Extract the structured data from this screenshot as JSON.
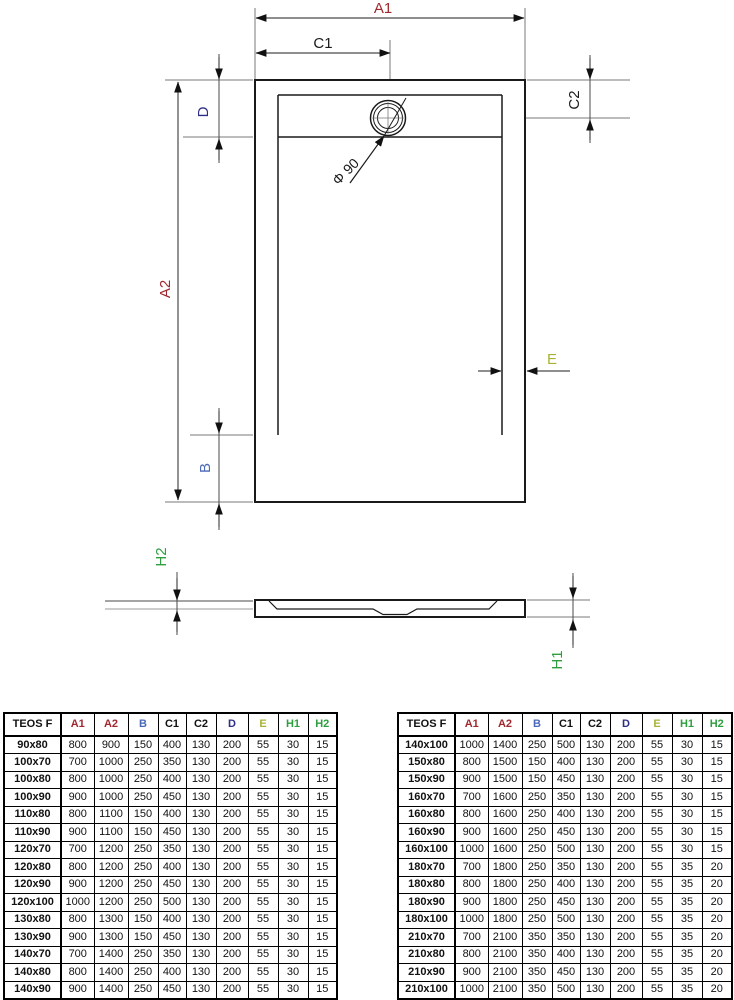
{
  "drawing": {
    "labels": {
      "a1": "A1",
      "c1": "C1",
      "c2": "C2",
      "d": "D",
      "a2": "A2",
      "b": "B",
      "e": "E",
      "drain_diameter": "Φ 90",
      "h1": "H1",
      "h2": "H2"
    },
    "colors": {
      "dim_red": "#a0282f",
      "dim_blue": "#4a69b8",
      "dim_navy": "#2d2e85",
      "dim_green": "#2e9e3e",
      "dim_olive": "#a8b237",
      "line_black": "#1a1a1a"
    }
  },
  "tables": {
    "headers": [
      "TEOS F",
      "A1",
      "A2",
      "B",
      "C1",
      "C2",
      "D",
      "E",
      "H1",
      "H2"
    ],
    "header_colors": [
      "#111111",
      "#a0282f",
      "#a0282f",
      "#4a69b8",
      "#111111",
      "#111111",
      "#2d2e85",
      "#a8b237",
      "#2e9e3e",
      "#2e9e3e"
    ],
    "left_rows": [
      [
        "90x80",
        800,
        900,
        150,
        400,
        130,
        200,
        55,
        30,
        15
      ],
      [
        "100x70",
        700,
        1000,
        250,
        350,
        130,
        200,
        55,
        30,
        15
      ],
      [
        "100x80",
        800,
        1000,
        250,
        400,
        130,
        200,
        55,
        30,
        15
      ],
      [
        "100x90",
        900,
        1000,
        250,
        450,
        130,
        200,
        55,
        30,
        15
      ],
      [
        "110x80",
        800,
        1100,
        150,
        400,
        130,
        200,
        55,
        30,
        15
      ],
      [
        "110x90",
        900,
        1100,
        150,
        450,
        130,
        200,
        55,
        30,
        15
      ],
      [
        "120x70",
        700,
        1200,
        250,
        350,
        130,
        200,
        55,
        30,
        15
      ],
      [
        "120x80",
        800,
        1200,
        250,
        400,
        130,
        200,
        55,
        30,
        15
      ],
      [
        "120x90",
        900,
        1200,
        250,
        450,
        130,
        200,
        55,
        30,
        15
      ],
      [
        "120x100",
        1000,
        1200,
        250,
        500,
        130,
        200,
        55,
        30,
        15
      ],
      [
        "130x80",
        800,
        1300,
        150,
        400,
        130,
        200,
        55,
        30,
        15
      ],
      [
        "130x90",
        900,
        1300,
        150,
        450,
        130,
        200,
        55,
        30,
        15
      ],
      [
        "140x70",
        700,
        1400,
        250,
        350,
        130,
        200,
        55,
        30,
        15
      ],
      [
        "140x80",
        800,
        1400,
        250,
        400,
        130,
        200,
        55,
        30,
        15
      ],
      [
        "140x90",
        900,
        1400,
        250,
        450,
        130,
        200,
        55,
        30,
        15
      ]
    ],
    "right_rows": [
      [
        "140x100",
        1000,
        1400,
        250,
        500,
        130,
        200,
        55,
        30,
        15
      ],
      [
        "150x80",
        800,
        1500,
        150,
        400,
        130,
        200,
        55,
        30,
        15
      ],
      [
        "150x90",
        900,
        1500,
        150,
        450,
        130,
        200,
        55,
        30,
        15
      ],
      [
        "160x70",
        700,
        1600,
        250,
        350,
        130,
        200,
        55,
        30,
        15
      ],
      [
        "160x80",
        800,
        1600,
        250,
        400,
        130,
        200,
        55,
        30,
        15
      ],
      [
        "160x90",
        900,
        1600,
        250,
        450,
        130,
        200,
        55,
        30,
        15
      ],
      [
        "160x100",
        1000,
        1600,
        250,
        500,
        130,
        200,
        55,
        30,
        15
      ],
      [
        "180x70",
        700,
        1800,
        250,
        350,
        130,
        200,
        55,
        35,
        20
      ],
      [
        "180x80",
        800,
        1800,
        250,
        400,
        130,
        200,
        55,
        35,
        20
      ],
      [
        "180x90",
        900,
        1800,
        250,
        450,
        130,
        200,
        55,
        35,
        20
      ],
      [
        "180x100",
        1000,
        1800,
        250,
        500,
        130,
        200,
        55,
        35,
        20
      ],
      [
        "210x70",
        700,
        2100,
        350,
        350,
        130,
        200,
        55,
        35,
        20
      ],
      [
        "210x80",
        800,
        2100,
        350,
        400,
        130,
        200,
        55,
        35,
        20
      ],
      [
        "210x90",
        900,
        2100,
        350,
        450,
        130,
        200,
        55,
        35,
        20
      ],
      [
        "210x100",
        1000,
        2100,
        350,
        500,
        130,
        200,
        55,
        35,
        20
      ]
    ]
  }
}
